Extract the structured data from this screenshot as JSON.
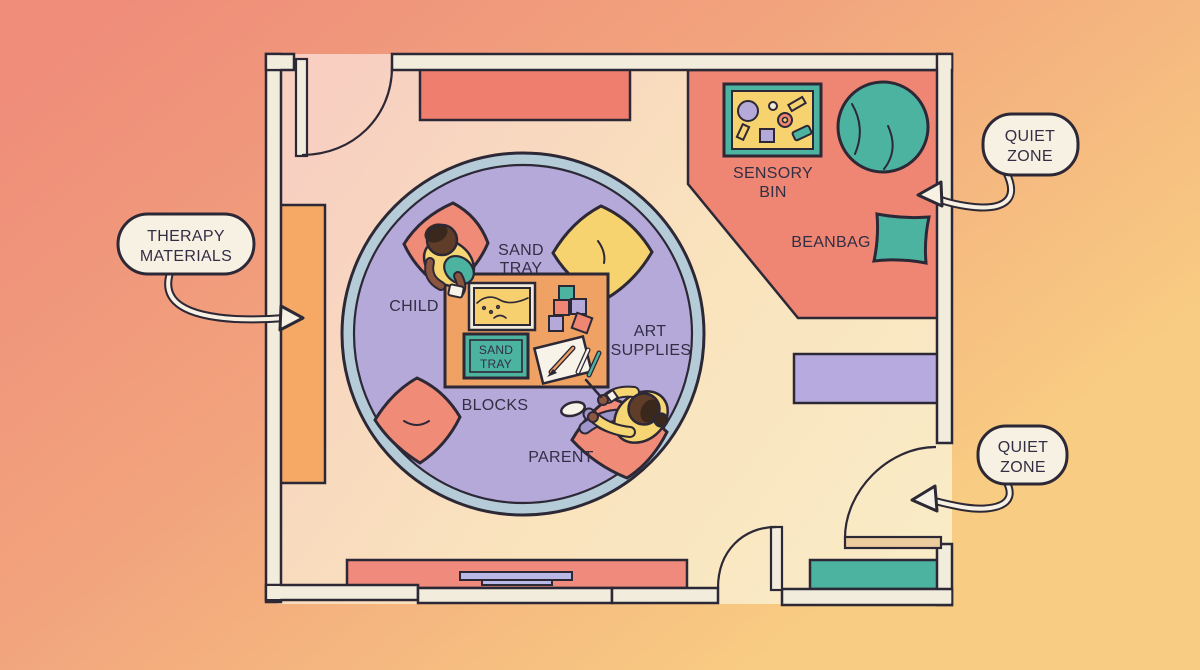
{
  "labels": {
    "sensory_bin": {
      "line1": "SENSORY",
      "line2": "BIN"
    },
    "beanbag": "BEANBAG",
    "sand_tray": {
      "line1": "SAND",
      "line2": "TRAY"
    },
    "sand_tray_plate": {
      "line1": "SAND",
      "line2": "TRAY"
    },
    "child": "CHILD",
    "art_supplies": {
      "line1": "ART",
      "line2": "SUPPLIES"
    },
    "blocks": "BLOCKS",
    "parent": "PARENT"
  },
  "callouts": {
    "therapy_materials": {
      "line1": "THERAPY",
      "line2": "MATERIALS"
    },
    "quiet_zone_top": {
      "line1": "QUIET",
      "line2": "ZONE"
    },
    "quiet_zone_bottom": {
      "line1": "QUIET",
      "line2": "ZONE"
    }
  },
  "palette": {
    "ink": "#2d2836",
    "ink_text": "#322e44",
    "cream": "#f2ecdc",
    "bubble": "#f7f1e3",
    "paper": "#f8f3e8",
    "bg_left": "#ef8d7a",
    "bg_mid": "#f2a47d",
    "bg_right": "#f8cc82",
    "floor_left": "#f8cfc1",
    "floor_right": "#f9ebc6",
    "salmon": "#ee8673",
    "shelf_red": "#ef7e6f",
    "bar_red": "#f08a7c",
    "pillow_salmon": "#f08b78",
    "orange_shelf": "#f5a965",
    "table_orange": "#efa263",
    "purple": "#b5a9da",
    "shelf_purple": "#b6aade",
    "periwinkle": "#b9b7e6",
    "ring_blue": "#b5ccd8",
    "pants": "#a095cb",
    "teal": "#4db3a1",
    "yellow": "#f7d36f",
    "sand": "#f6cf6e",
    "shirt_yellow": "#f6d573",
    "skin": "#8a5640",
    "head_brown": "#5f3d29",
    "hair_dark": "#3a281c",
    "tan_door": "#eccb9f"
  }
}
